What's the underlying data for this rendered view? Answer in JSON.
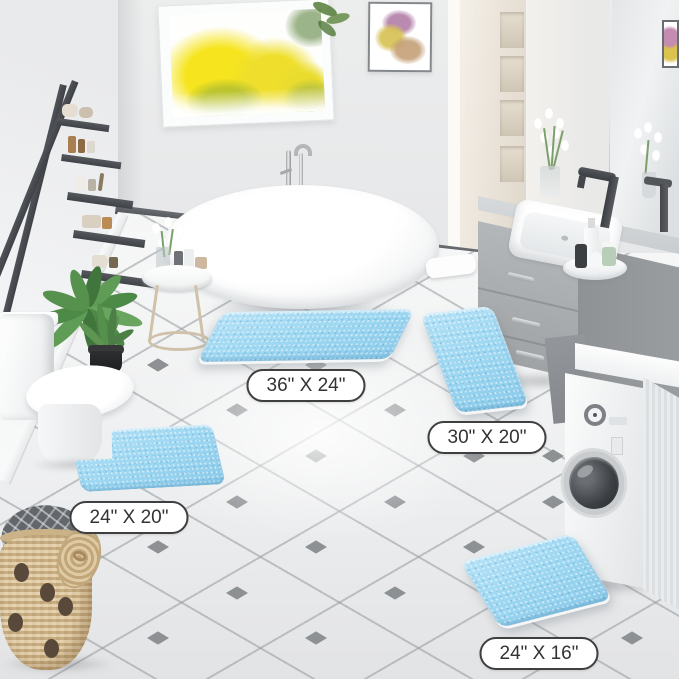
{
  "scene": {
    "setting": "bathroom",
    "image_type": "product-lifestyle-photo"
  },
  "mats": [
    {
      "id": "mat-36x24",
      "size_label": "36\" X 24\"",
      "shape": "rectangle"
    },
    {
      "id": "mat-30x20",
      "size_label": "30\" X 20\"",
      "shape": "rectangle"
    },
    {
      "id": "mat-24x20-contour",
      "size_label": "24\" X 20\"",
      "shape": "u-contour"
    },
    {
      "id": "mat-24x16",
      "size_label": "24\" X 16\"",
      "shape": "rectangle"
    }
  ],
  "colors": {
    "mat_blue": "#a6dbf3",
    "label_background": "#ffffff",
    "label_border": "#3f3f3f",
    "label_text": "#333333",
    "floor_tile": "#f2f3f4",
    "accent_diamond": "#8e9194",
    "wall": "#e8e9ea",
    "vanity_gray": "#a8abae",
    "window_foliage_yellow": "#f2e32a"
  }
}
